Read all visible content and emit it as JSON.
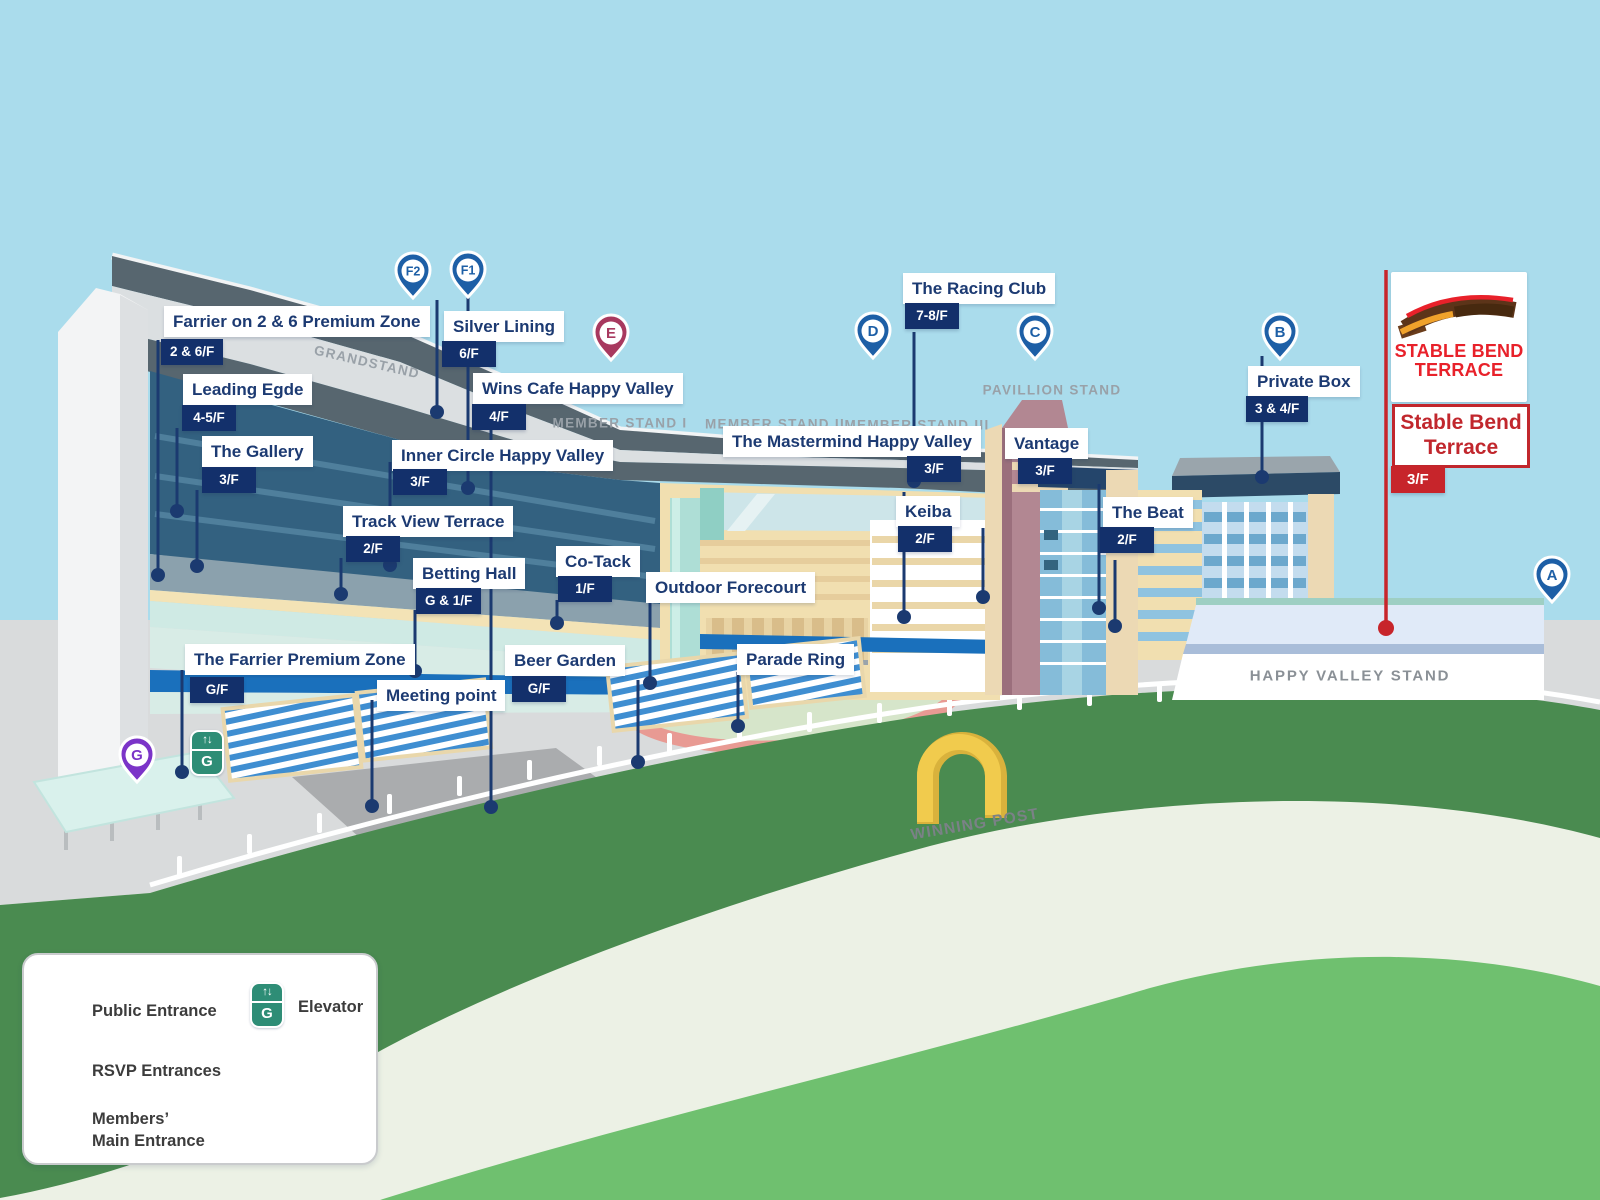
{
  "colors": {
    "navy_line": "#1b3a70",
    "badge_navy": "#13306b",
    "label_text": "#1c3a72",
    "pin_blue": "#1d5fa6",
    "pin_purple": "#7b34c8",
    "pin_maroon": "#a8395f",
    "elevator_teal": "#2e8d76",
    "brand_red": "#e8212a",
    "callout_red": "#c1272d",
    "track_green": "#4a8b50",
    "walkway_blue": "#1a70bc"
  },
  "venues": {
    "farrier_zone": {
      "name": "Farrier on 2 & 6 Premium Zone",
      "floor": "2 & 6/F"
    },
    "silver_lining": {
      "name": "Silver Lining",
      "floor": "6/F"
    },
    "leading_egde": {
      "name": "Leading Egde",
      "floor": "4-5/F"
    },
    "gallery": {
      "name": "The Gallery",
      "floor": "3/F"
    },
    "wins_cafe": {
      "name": "Wins Cafe Happy Valley",
      "floor": "4/F"
    },
    "inner_circle": {
      "name": "Inner Circle Happy Valley",
      "floor": "3/F"
    },
    "track_view": {
      "name": "Track View Terrace",
      "floor": "2/F"
    },
    "betting_hall": {
      "name": "Betting Hall",
      "floor": "G & 1/F"
    },
    "co_tack": {
      "name": "Co-Tack",
      "floor": "1/F"
    },
    "outdoor_forecourt": {
      "name": "Outdoor Forecourt"
    },
    "farrier_premium": {
      "name": "The Farrier Premium Zone",
      "floor": "G/F"
    },
    "meeting_point": {
      "name": "Meeting point"
    },
    "beer_garden": {
      "name": "Beer Garden",
      "floor": "G/F"
    },
    "parade_ring": {
      "name": "Parade Ring"
    },
    "mastermind": {
      "name": "The Mastermind Happy Valley",
      "floor": "3/F"
    },
    "keiba": {
      "name": "Keiba",
      "floor": "2/F"
    },
    "vantage": {
      "name": "Vantage",
      "floor": "3/F"
    },
    "the_beat": {
      "name": "The Beat",
      "floor": "2/F"
    },
    "racing_club": {
      "name": "The Racing Club",
      "floor": "7-8/F"
    },
    "private_box": {
      "name": "Private Box",
      "floor": "3 & 4/F"
    }
  },
  "stands": {
    "grandstand": "GRANDSTAND",
    "member1": "MEMBER STAND I",
    "member2": "MEMBER STAND II",
    "member3": "MEMBER STAND III",
    "pavillion": "PAVILLION STAND",
    "happy_valley": "HAPPY VALLEY STAND"
  },
  "pins": {
    "f2": "F2",
    "f1": "F1",
    "e": "E",
    "d": "D",
    "c": "C",
    "b": "B",
    "a": "A",
    "g": "G"
  },
  "stable_bend": {
    "logo_line1": "STABLE BEND",
    "logo_line2": "TERRACE",
    "callout_line1": "Stable Bend",
    "callout_line2": "Terrace",
    "floor": "3/F"
  },
  "track": {
    "winning_post": "WINNING POST"
  },
  "elevator": {
    "arrows": "↑↓",
    "letter": "G"
  },
  "legend": {
    "public": "Public Entrance",
    "rsvp": "RSVP Entrances",
    "members_line1": "Members’",
    "members_line2": "Main Entrance",
    "elevator": "Elevator"
  }
}
